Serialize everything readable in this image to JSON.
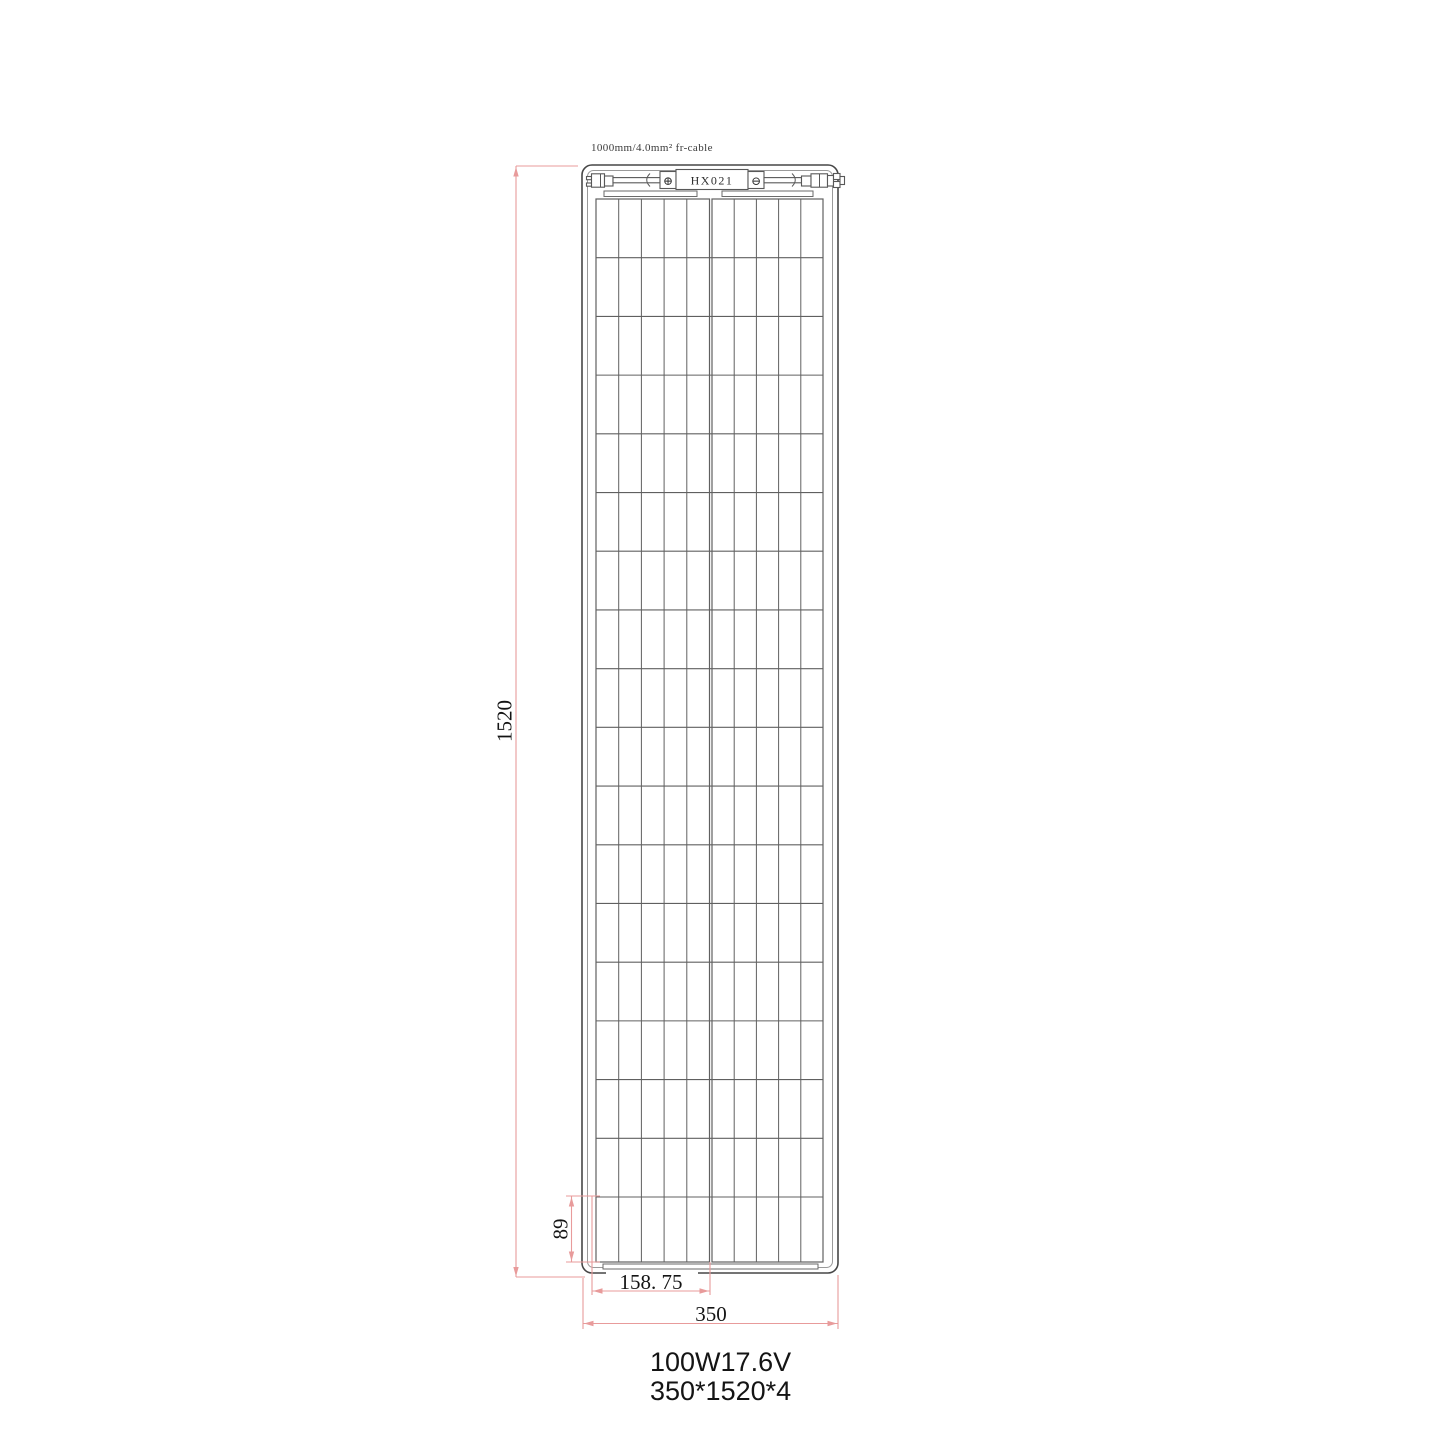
{
  "labels": {
    "cable": "1000mm/4.0mm² fr-cable",
    "junction_box": "HX021",
    "polarity_plus": "⊕",
    "polarity_minus": "⊖"
  },
  "dimensions": {
    "panel_height_mm": "1520",
    "panel_width_mm": "350",
    "cell_group_width_mm": "158. 75",
    "bottom_row_height_mm": "89"
  },
  "specs": {
    "power_voltage": "100W17.6V",
    "size": "350*1520*4"
  },
  "panel": {
    "rows": 18,
    "columns_per_half": 5,
    "halves": 2
  },
  "colors": {
    "dimension_line": "#e89b9b",
    "drawing_line": "#606060",
    "frame_line": "#474747",
    "text": "#141414"
  }
}
